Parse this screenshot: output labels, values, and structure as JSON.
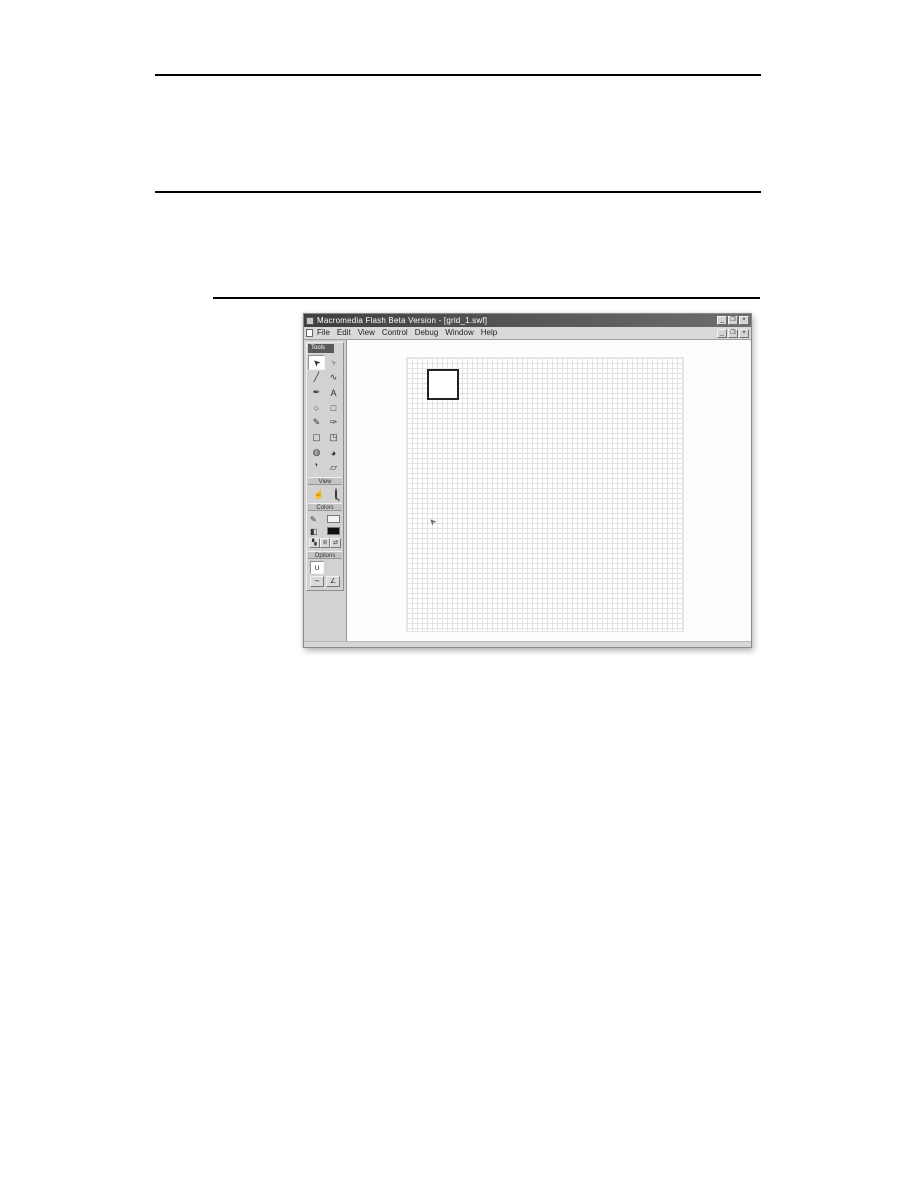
{
  "window": {
    "title": "Macromedia Flash Beta Version - [grid_1.swf]",
    "title_controls": [
      {
        "name": "minimize",
        "glyph": "_"
      },
      {
        "name": "restore",
        "glyph": "❐"
      },
      {
        "name": "close",
        "glyph": "×"
      }
    ],
    "menu": {
      "items": [
        "File",
        "Edit",
        "View",
        "Control",
        "Debug",
        "Window",
        "Help"
      ],
      "controls": [
        {
          "name": "minimize",
          "glyph": "_"
        },
        {
          "name": "restore",
          "glyph": "❐"
        },
        {
          "name": "close",
          "glyph": "×"
        }
      ]
    },
    "toolbar": {
      "header": "Tools",
      "tools": [
        {
          "name": "arrow",
          "glyph": "➤",
          "selected": true
        },
        {
          "name": "subselection",
          "glyph": "➢"
        },
        {
          "name": "line",
          "glyph": "╱"
        },
        {
          "name": "lasso",
          "glyph": "∿"
        },
        {
          "name": "pen",
          "glyph": "✒"
        },
        {
          "name": "text",
          "glyph": "A"
        },
        {
          "name": "oval",
          "glyph": "○"
        },
        {
          "name": "rectangle",
          "glyph": "□"
        },
        {
          "name": "pencil",
          "glyph": "✎"
        },
        {
          "name": "brush",
          "glyph": "✑"
        },
        {
          "name": "free-transform",
          "glyph": "▢"
        },
        {
          "name": "fill-transform",
          "glyph": "◳"
        },
        {
          "name": "ink-bottle",
          "glyph": "◍"
        },
        {
          "name": "paint-bucket",
          "glyph": "◕"
        },
        {
          "name": "eyedropper",
          "glyph": "❜"
        },
        {
          "name": "eraser",
          "glyph": "▱"
        }
      ],
      "view": {
        "label": "View",
        "hand_glyph": "☝"
      },
      "colors": {
        "label": "Colors",
        "stroke_glyph": "✎",
        "fill_glyph": "◧",
        "stroke_swatch": "#f2f2f2",
        "fill_swatch": "#111111",
        "default_glyph": "▚",
        "none_glyph": "⊘",
        "swap_glyph": "⇄"
      },
      "options": {
        "label": "Options",
        "snap_glyph": "∪",
        "smooth_glyph": "∼",
        "straighten_glyph": "∠"
      }
    },
    "stage": {
      "grid_spacing_px": 5,
      "grid_color": "#e2e2e2",
      "background": "#ffffff",
      "square": {
        "x": 20,
        "y": 11,
        "width": 32,
        "height": 31,
        "border_color": "#222222"
      },
      "cursor": {
        "x": 22,
        "y": 158,
        "glyph": "➤"
      }
    }
  },
  "colors": {
    "page_background": "#ffffff",
    "rule": "#000000",
    "window_chrome": "#d6d6d6",
    "titlebar_dark": "#3f3f3f",
    "panel": "#d2d2d2"
  }
}
